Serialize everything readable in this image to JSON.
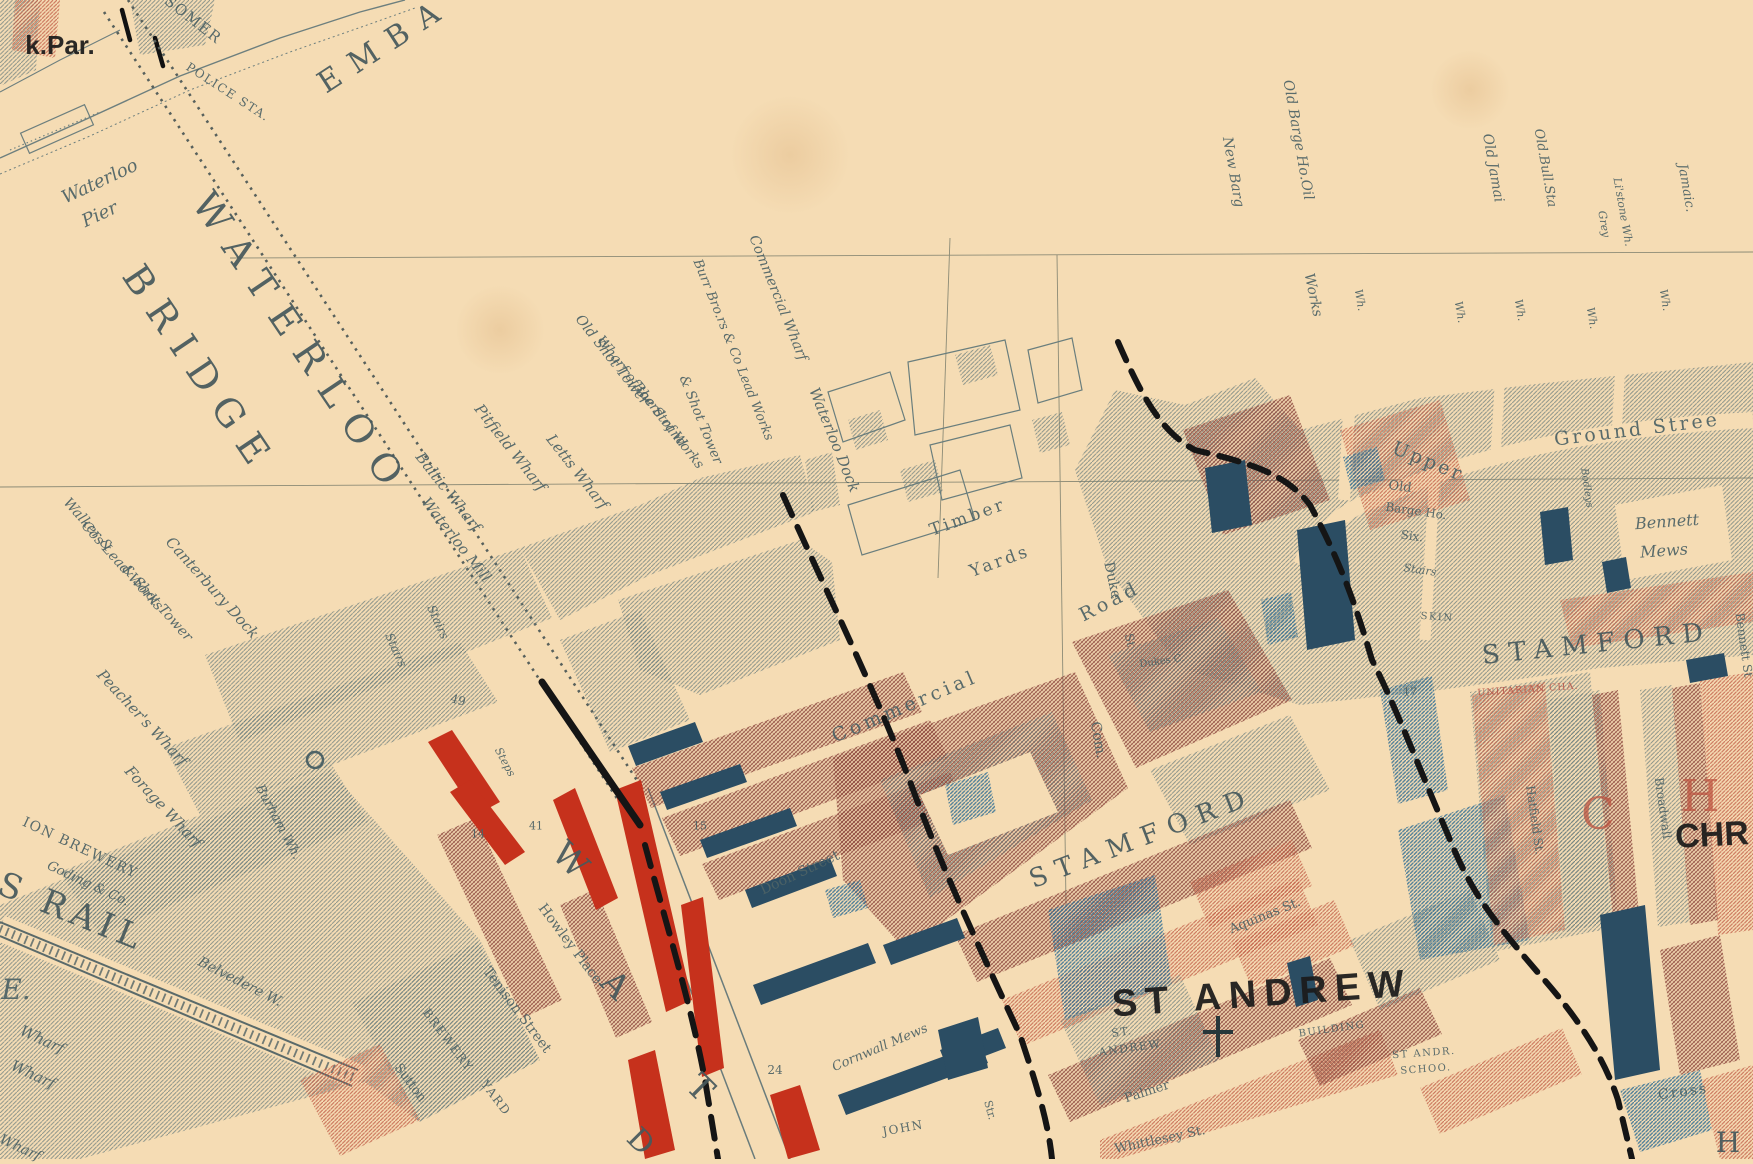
{
  "map": {
    "palette": {
      "parchment": "#f5dcb4",
      "ink_gray": "#4e6366",
      "big_caps_gray": "#47595c",
      "label_black": "#1b1b1b",
      "label_red": "#b9574a",
      "hatch_gray": "#64797a",
      "hatch_red": "#c05c46",
      "hatch_maroon": "#8e4a40",
      "hatch_blue": "#2f6d94",
      "solid_navy": "#2b4d63",
      "solid_vermilion": "#c6311c",
      "boundary_black": "#151515",
      "hairline": "#8c8b76"
    },
    "labels": [
      {
        "t": "k.Par.",
        "x": 60,
        "y": 45,
        "r": 0,
        "s": 26,
        "c": "blk"
      },
      {
        "t": "SOMER",
        "x": 193,
        "y": 20,
        "r": 38,
        "s": 15,
        "c": "sc"
      },
      {
        "t": "POLICE STA.",
        "x": 228,
        "y": 92,
        "r": 33,
        "s": 12,
        "c": "sc"
      },
      {
        "t": "EMBA",
        "x": 385,
        "y": 45,
        "r": -33,
        "s": 30,
        "c": "big",
        "ls": 14
      },
      {
        "t": "Waterloo",
        "x": 100,
        "y": 182,
        "r": -25,
        "s": 18,
        "c": "it"
      },
      {
        "t": "Pier",
        "x": 100,
        "y": 215,
        "r": -25,
        "s": 18,
        "c": "it"
      },
      {
        "t": "WATERLOO",
        "x": 302,
        "y": 345,
        "r": 56,
        "s": 38,
        "c": "big",
        "ls": 16
      },
      {
        "t": "BRIDGE",
        "x": 200,
        "y": 370,
        "r": 56,
        "s": 38,
        "c": "big",
        "ls": 14
      },
      {
        "t": "Walker &",
        "x": 88,
        "y": 525,
        "r": 48,
        "s": 14,
        "c": "it"
      },
      {
        "t": "Cos Lead Works",
        "x": 122,
        "y": 566,
        "r": 48,
        "s": 14,
        "c": "it"
      },
      {
        "t": "& Shot Tower",
        "x": 157,
        "y": 603,
        "r": 48,
        "s": 14,
        "c": "it"
      },
      {
        "t": "Canterbury Dock",
        "x": 212,
        "y": 588,
        "r": 48,
        "s": 15,
        "c": "it"
      },
      {
        "t": "Peacher's Wharf",
        "x": 142,
        "y": 718,
        "r": 47,
        "s": 15,
        "c": "it"
      },
      {
        "t": "Forage Wharf",
        "x": 163,
        "y": 807,
        "r": 47,
        "s": 15,
        "c": "it"
      },
      {
        "t": "ION BREWERY",
        "x": 80,
        "y": 848,
        "r": 25,
        "s": 14,
        "c": "sc"
      },
      {
        "t": "Goding & Co.",
        "x": 88,
        "y": 884,
        "r": 25,
        "s": 13,
        "c": "it"
      },
      {
        "t": "S RAIL",
        "x": 72,
        "y": 912,
        "r": 22,
        "s": 34,
        "c": "big",
        "ls": 6
      },
      {
        "t": "E.",
        "x": 16,
        "y": 990,
        "r": 0,
        "s": 28,
        "c": "it"
      },
      {
        "t": "Wharf",
        "x": 42,
        "y": 1040,
        "r": 25,
        "s": 15,
        "c": "it"
      },
      {
        "t": "Wharf",
        "x": 33,
        "y": 1075,
        "r": 25,
        "s": 15,
        "c": "it"
      },
      {
        "t": "Wharf",
        "x": 20,
        "y": 1148,
        "r": 25,
        "s": 14,
        "c": "it"
      },
      {
        "t": "Burham Wh.",
        "x": 278,
        "y": 822,
        "r": 62,
        "s": 13,
        "c": "it"
      },
      {
        "t": "Belvedere W.",
        "x": 240,
        "y": 982,
        "r": 27,
        "s": 14,
        "c": "it"
      },
      {
        "t": "Stairs",
        "x": 438,
        "y": 622,
        "r": 66,
        "s": 12,
        "c": "it"
      },
      {
        "t": "Stairs",
        "x": 396,
        "y": 650,
        "r": 66,
        "s": 12,
        "c": "it"
      },
      {
        "t": "49",
        "x": 458,
        "y": 700,
        "r": 15,
        "s": 12,
        "c": "num"
      },
      {
        "t": "Steps",
        "x": 505,
        "y": 762,
        "r": 62,
        "s": 11,
        "c": "it"
      },
      {
        "t": "Baltic Wharf",
        "x": 448,
        "y": 492,
        "r": 52,
        "s": 15,
        "c": "it"
      },
      {
        "t": "Waterloo Mill",
        "x": 456,
        "y": 540,
        "r": 52,
        "s": 15,
        "c": "it"
      },
      {
        "t": "Pitfield Wharf",
        "x": 510,
        "y": 448,
        "r": 52,
        "s": 15,
        "c": "it"
      },
      {
        "t": "Letts Wharf",
        "x": 577,
        "y": 472,
        "r": 52,
        "s": 15,
        "c": "it"
      },
      {
        "t": "Old Shot Tower",
        "x": 612,
        "y": 360,
        "r": 52,
        "s": 14,
        "c": "it"
      },
      {
        "t": "Wharf of the Strand",
        "x": 641,
        "y": 392,
        "r": 52,
        "s": 13.5,
        "c": "it"
      },
      {
        "t": "Board of Works",
        "x": 668,
        "y": 426,
        "r": 52,
        "s": 13.5,
        "c": "it"
      },
      {
        "t": "& Shot Tower",
        "x": 700,
        "y": 420,
        "r": 68,
        "s": 13.5,
        "c": "it"
      },
      {
        "t": "Burr Bro.rs & Co Lead Works",
        "x": 733,
        "y": 350,
        "r": 68,
        "s": 13,
        "c": "it"
      },
      {
        "t": "Commercial Wharf",
        "x": 778,
        "y": 298,
        "r": 68,
        "s": 14,
        "c": "it"
      },
      {
        "t": "Waterloo Dock",
        "x": 834,
        "y": 440,
        "r": 68,
        "s": 15,
        "c": "it"
      },
      {
        "t": "Timber",
        "x": 968,
        "y": 518,
        "r": -20,
        "s": 17,
        "c": "st",
        "ls": 3
      },
      {
        "t": "Yards",
        "x": 1000,
        "y": 562,
        "r": -20,
        "s": 17,
        "c": "st",
        "ls": 3
      },
      {
        "t": "Old Barge Ho.Oil",
        "x": 1298,
        "y": 140,
        "r": 80,
        "s": 14,
        "c": "it"
      },
      {
        "t": "Works",
        "x": 1313,
        "y": 295,
        "r": 78,
        "s": 14,
        "c": "it"
      },
      {
        "t": "New Barg",
        "x": 1233,
        "y": 172,
        "r": 80,
        "s": 14,
        "c": "it"
      },
      {
        "t": "Old Jamai",
        "x": 1493,
        "y": 168,
        "r": 80,
        "s": 14,
        "c": "it"
      },
      {
        "t": "Old.Bull.Sta",
        "x": 1545,
        "y": 168,
        "r": 80,
        "s": 13,
        "c": "it"
      },
      {
        "t": "Grey",
        "x": 1604,
        "y": 224,
        "r": 80,
        "s": 11,
        "c": "it"
      },
      {
        "t": "Li'stone Wh.",
        "x": 1623,
        "y": 212,
        "r": 80,
        "s": 11,
        "c": "it"
      },
      {
        "t": "Jamaic.",
        "x": 1686,
        "y": 188,
        "r": 80,
        "s": 13,
        "c": "it"
      },
      {
        "t": "Wh.",
        "x": 1360,
        "y": 300,
        "r": 80,
        "s": 11,
        "c": "it"
      },
      {
        "t": "Wh.",
        "x": 1460,
        "y": 312,
        "r": 80,
        "s": 11,
        "c": "it"
      },
      {
        "t": "Wh.",
        "x": 1520,
        "y": 310,
        "r": 80,
        "s": 11,
        "c": "it"
      },
      {
        "t": "Wh.",
        "x": 1592,
        "y": 318,
        "r": 80,
        "s": 11,
        "c": "it"
      },
      {
        "t": "Wh.",
        "x": 1665,
        "y": 300,
        "r": 80,
        "s": 11,
        "c": "it"
      },
      {
        "t": "Upper",
        "x": 1428,
        "y": 462,
        "r": 22,
        "s": 19,
        "c": "st",
        "ls": 3
      },
      {
        "t": "Ground Stree",
        "x": 1637,
        "y": 430,
        "r": -7,
        "s": 19,
        "c": "st",
        "ls": 3
      },
      {
        "t": "Old",
        "x": 1400,
        "y": 487,
        "r": 8,
        "s": 13,
        "c": "st"
      },
      {
        "t": "Barge Ho.",
        "x": 1416,
        "y": 511,
        "r": 8,
        "s": 12,
        "c": "st"
      },
      {
        "t": "Six.",
        "x": 1412,
        "y": 536,
        "r": 8,
        "s": 12,
        "c": "st"
      },
      {
        "t": "Stairs",
        "x": 1420,
        "y": 570,
        "r": 8,
        "s": 11,
        "c": "it"
      },
      {
        "t": "SKIN",
        "x": 1437,
        "y": 618,
        "r": 4,
        "s": 10,
        "c": "sc"
      },
      {
        "t": "Bennett",
        "x": 1667,
        "y": 522,
        "r": -4,
        "s": 16,
        "c": "it"
      },
      {
        "t": "Mews",
        "x": 1664,
        "y": 551,
        "r": -4,
        "s": 16,
        "c": "it"
      },
      {
        "t": "Bennett St",
        "x": 1744,
        "y": 645,
        "r": 82,
        "s": 12,
        "c": "st"
      },
      {
        "t": "Bodleys",
        "x": 1586,
        "y": 488,
        "r": 82,
        "s": 10,
        "c": "it"
      },
      {
        "t": "17",
        "x": 1410,
        "y": 692,
        "r": 0,
        "s": 11,
        "c": "num"
      },
      {
        "t": "UNITARIAN CHA.",
        "x": 1528,
        "y": 690,
        "r": -4,
        "s": 9.5,
        "c": "red"
      },
      {
        "t": "Hatfield St.",
        "x": 1535,
        "y": 820,
        "r": 82,
        "s": 12,
        "c": "st"
      },
      {
        "t": "Broadwall",
        "x": 1663,
        "y": 808,
        "r": 82,
        "s": 12,
        "c": "st"
      },
      {
        "t": "C",
        "x": 1598,
        "y": 815,
        "r": 0,
        "s": 44,
        "c": "redbig"
      },
      {
        "t": "H",
        "x": 1700,
        "y": 797,
        "r": 0,
        "s": 44,
        "c": "redbig"
      },
      {
        "t": "CHR",
        "x": 1712,
        "y": 835,
        "r": -3,
        "s": 34,
        "c": "blk"
      },
      {
        "t": "STAMFORD",
        "x": 1142,
        "y": 838,
        "r": -21,
        "s": 26,
        "c": "big",
        "ls": 10
      },
      {
        "t": "STAMFORD",
        "x": 1597,
        "y": 644,
        "r": -6,
        "s": 26,
        "c": "big",
        "ls": 9
      },
      {
        "t": "Commercial",
        "x": 905,
        "y": 707,
        "r": -23,
        "s": 19,
        "c": "st",
        "ls": 4
      },
      {
        "t": "Road",
        "x": 1110,
        "y": 602,
        "r": -27,
        "s": 19,
        "c": "st",
        "ls": 4
      },
      {
        "t": "Com.",
        "x": 1098,
        "y": 740,
        "r": 80,
        "s": 14,
        "c": "st"
      },
      {
        "t": "Duke",
        "x": 1112,
        "y": 580,
        "r": 78,
        "s": 14,
        "c": "st"
      },
      {
        "t": "St",
        "x": 1130,
        "y": 640,
        "r": 78,
        "s": 12,
        "c": "st"
      },
      {
        "t": "Dukes C.",
        "x": 1162,
        "y": 662,
        "r": -8,
        "s": 10,
        "c": "st"
      },
      {
        "t": "Doon Street",
        "x": 800,
        "y": 873,
        "r": -25,
        "s": 14,
        "c": "st"
      },
      {
        "t": "15",
        "x": 700,
        "y": 826,
        "r": 0,
        "s": 11,
        "c": "num"
      },
      {
        "t": "24",
        "x": 775,
        "y": 1070,
        "r": 0,
        "s": 12,
        "c": "num"
      },
      {
        "t": "14",
        "x": 478,
        "y": 834,
        "r": 0,
        "s": 11,
        "c": "num"
      },
      {
        "t": "41",
        "x": 536,
        "y": 826,
        "r": 0,
        "s": 11,
        "c": "num"
      },
      {
        "t": "Cornwall Mews",
        "x": 880,
        "y": 1048,
        "r": -23,
        "s": 13,
        "c": "it"
      },
      {
        "t": "JOHN",
        "x": 903,
        "y": 1128,
        "r": -10,
        "s": 12,
        "c": "sc"
      },
      {
        "t": "Howley Place",
        "x": 570,
        "y": 944,
        "r": 53,
        "s": 14,
        "c": "st"
      },
      {
        "t": "Tenison Street",
        "x": 517,
        "y": 1010,
        "r": 53,
        "s": 14,
        "c": "st"
      },
      {
        "t": "BREWERY",
        "x": 448,
        "y": 1040,
        "r": 53,
        "s": 12,
        "c": "sc"
      },
      {
        "t": "YARD",
        "x": 496,
        "y": 1098,
        "r": 53,
        "s": 12,
        "c": "sc"
      },
      {
        "t": "Sutton",
        "x": 410,
        "y": 1083,
        "r": 53,
        "s": 13,
        "c": "st"
      },
      {
        "t": "W",
        "x": 570,
        "y": 860,
        "r": 45,
        "s": 34,
        "c": "big"
      },
      {
        "t": "A",
        "x": 615,
        "y": 985,
        "r": 45,
        "s": 34,
        "c": "big"
      },
      {
        "t": "T",
        "x": 700,
        "y": 1088,
        "r": 45,
        "s": 34,
        "c": "big"
      },
      {
        "t": "D",
        "x": 640,
        "y": 1142,
        "r": 45,
        "s": 30,
        "c": "big"
      },
      {
        "t": "ST ANDREW",
        "x": 1262,
        "y": 994,
        "r": -4,
        "s": 38,
        "c": "blk",
        "ls": 8
      },
      {
        "t": "ST.",
        "x": 1122,
        "y": 1032,
        "r": -8,
        "s": 11,
        "c": "sc"
      },
      {
        "t": "ANDREW",
        "x": 1130,
        "y": 1048,
        "r": -8,
        "s": 11,
        "c": "sc"
      },
      {
        "t": "Aquinas St.",
        "x": 1265,
        "y": 916,
        "r": -22,
        "s": 13,
        "c": "st"
      },
      {
        "t": "BUILDING",
        "x": 1332,
        "y": 1030,
        "r": -8,
        "s": 10,
        "c": "sc"
      },
      {
        "t": "ST ANDR.",
        "x": 1424,
        "y": 1054,
        "r": -4,
        "s": 10,
        "c": "sc"
      },
      {
        "t": "SCHOO.",
        "x": 1426,
        "y": 1070,
        "r": -4,
        "s": 10,
        "c": "sc"
      },
      {
        "t": "Palmer",
        "x": 1147,
        "y": 1092,
        "r": -18,
        "s": 13,
        "c": "st"
      },
      {
        "t": "Whittlesey St.",
        "x": 1160,
        "y": 1140,
        "r": -12,
        "s": 13,
        "c": "st"
      },
      {
        "t": "Str.",
        "x": 990,
        "y": 1110,
        "r": 75,
        "s": 11,
        "c": "st"
      },
      {
        "t": "Cross",
        "x": 1683,
        "y": 1092,
        "r": -8,
        "s": 14,
        "c": "st",
        "ls": 2
      },
      {
        "t": "H",
        "x": 1728,
        "y": 1143,
        "r": 0,
        "s": 28,
        "c": "big"
      }
    ]
  }
}
